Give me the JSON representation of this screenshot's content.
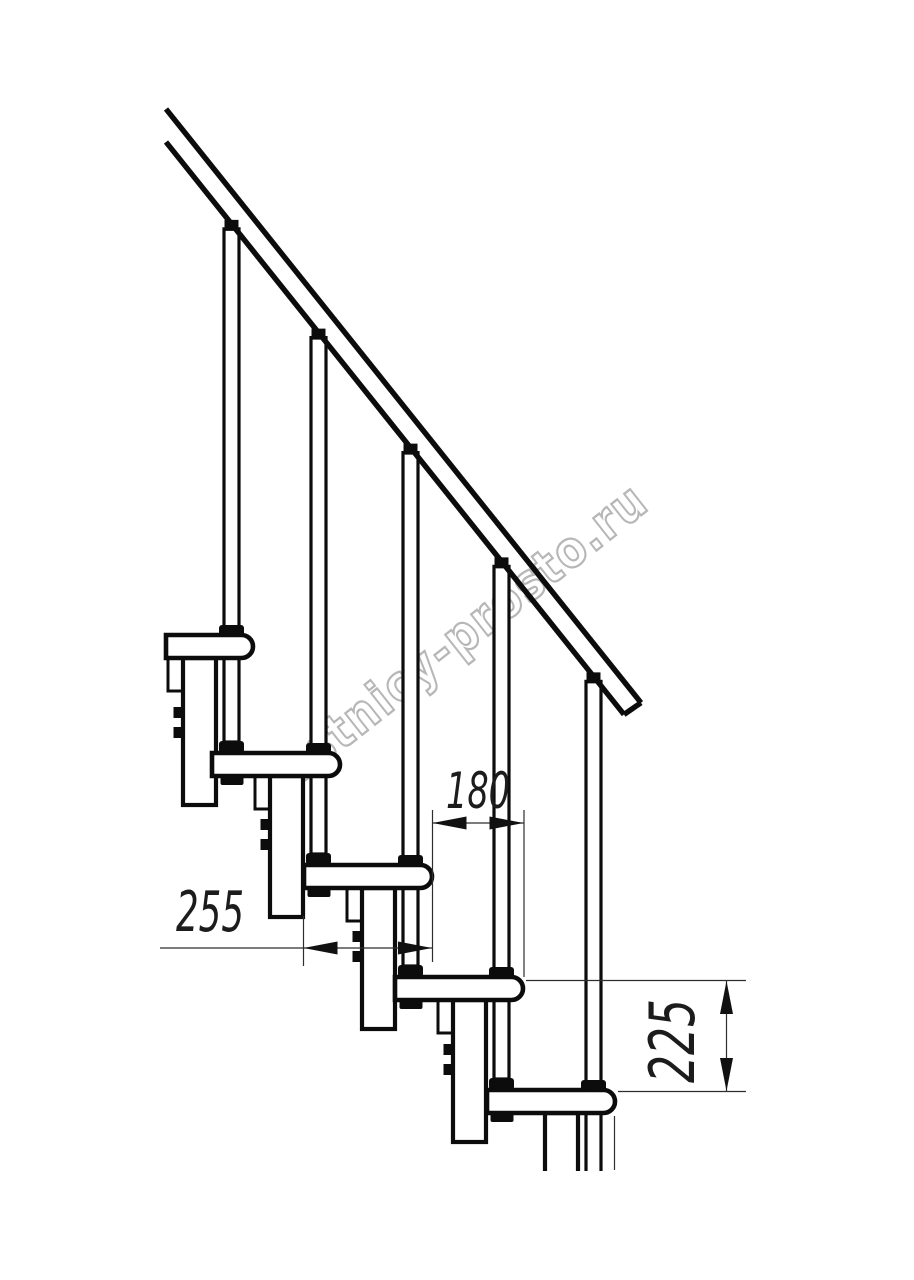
{
  "page": {
    "background": "#ffffff",
    "width_px": 914,
    "height_px": 1280
  },
  "watermark": {
    "text": "lestnicy-prosto.ru",
    "outline_color": "#b7b7b7",
    "fill_color": "rgba(255,255,255,0.92)",
    "angle_deg": -38.2,
    "anchor_x": 282,
    "anchor_y": 798,
    "font_size": 50,
    "text_length": 470
  },
  "drawing": {
    "type": "staircase-side-elevation",
    "line_color": "#0c0c0c",
    "dim_color": "#2e2e2e",
    "arrow_color": "#111111",
    "main_stroke": 4.6,
    "post_stroke": 3.2,
    "rail": {
      "x0": 166,
      "upper_y0": 109,
      "lower_y0": 142,
      "slope": 1.25,
      "end_upper_x": 641,
      "end_lower_x": 624
    },
    "tread": {
      "depth_px": 128,
      "thickness_px": 23,
      "nose_radius": 11.5
    },
    "steps": [
      {
        "nosing_x": 253,
        "tread_top_y": 635,
        "tread_left_x": 166
      },
      {
        "nosing_x": 340,
        "tread_top_y": 753
      },
      {
        "nosing_x": 432,
        "tread_top_y": 865
      },
      {
        "nosing_x": 523,
        "tread_top_y": 977
      },
      {
        "nosing_x": 615,
        "tread_top_y": 1090,
        "cut_bottom_y": 1171
      }
    ]
  },
  "dimensions": {
    "tread_depth": {
      "label": "255",
      "value_mm": 255,
      "orientation": "horizontal",
      "line_y": 948,
      "from_x": 303.5,
      "to_x": 432,
      "leader_start_x": 160,
      "ext_lines": [
        {
          "x": 303.5,
          "y1": 916,
          "y2": 966
        }
      ],
      "label_cx": 210,
      "label_baseline_y": 931,
      "font_size": 56,
      "text_length": 68
    },
    "step_run": {
      "label": "180",
      "value_mm": 180,
      "orientation": "horizontal",
      "line_y": 823,
      "from_x": 432.5,
      "to_x": 523.5,
      "ext_lines": [
        {
          "x": 432.5,
          "y1": 810,
          "y2": 962
        },
        {
          "x": 524,
          "y1": 810,
          "y2": 977
        }
      ],
      "label_cx": 478,
      "label_baseline_y": 808,
      "font_size": 50,
      "text_length": 64
    },
    "step_rise": {
      "label": "225",
      "value_mm": 225,
      "orientation": "vertical",
      "line_x": 726.5,
      "from_y": 981,
      "to_y": 1091,
      "ext_lines": [
        {
          "y": 980.5,
          "x1": 526,
          "x2": 746
        },
        {
          "y": 1091.5,
          "x1": 618,
          "x2": 746
        }
      ],
      "stub_line": {
        "x": 614.5,
        "y1": 1116,
        "y2": 1170
      },
      "label_cx": 694,
      "label_cy": 1041,
      "font_size": 62,
      "text_length": 84
    }
  }
}
